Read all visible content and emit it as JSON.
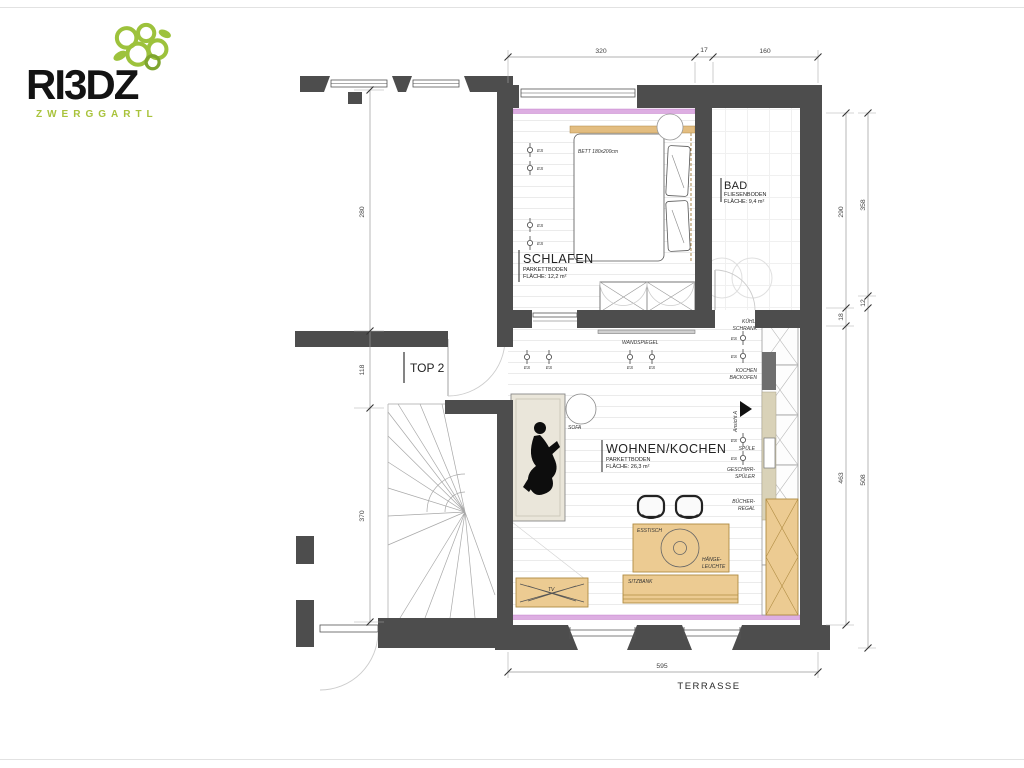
{
  "logo": {
    "brand": "RI3DZ",
    "subtitle": "ZWERGGARTL"
  },
  "plan": {
    "unit_label": "TOP 2",
    "rooms": {
      "schlafen": {
        "name": "SCHLAFEN",
        "floor": "PARKETTBODEN",
        "area": "FLÄCHE: 12,2 m²"
      },
      "bad": {
        "name": "BAD",
        "floor": "FLIESENBODEN",
        "area": "FLÄCHE: 9,4 m²"
      },
      "wohnen": {
        "name": "WOHNEN/KOCHEN",
        "floor": "PARKETTBODEN",
        "area": "FLÄCHE: 26,3 m²"
      }
    },
    "furniture": {
      "bett": "BETT 180x200cm",
      "sofa": "SOFA",
      "esstisch": "ESSTISCH",
      "haengeleuchte1": "HÄNGE-",
      "haengeleuchte2": "LEUCHTE",
      "sitzbank": "SITZBANK",
      "tv": "TV",
      "wandspiegel": "WANDSPIEGEL"
    },
    "kitchen": {
      "kuehl1": "KÜHL-",
      "kuehl2": "SCHRANK",
      "kochen1": "KOCHEN",
      "kochen2": "BACKOFEN",
      "spuele": "SPÜLE",
      "geschirr1": "GESCHIRR-",
      "geschirr2": "SPÜLER",
      "buecher1": "BÜCHER-",
      "buecher2": "REGAL",
      "ansicht": "Ansicht A"
    },
    "symbols": {
      "es": "ES"
    },
    "dims": {
      "top": [
        "320",
        "17",
        "160"
      ],
      "left": [
        "280",
        "118",
        "370"
      ],
      "right_inner": [
        "290",
        "18",
        "463"
      ],
      "right_outer": [
        "358",
        "12",
        "508"
      ],
      "bottom": [
        "595"
      ]
    },
    "terrasse": "TERRASSE",
    "colors": {
      "wall": "#4d4d4d",
      "accent_tan": "#eccb92",
      "accent_magenta": "#ddaee2",
      "logo_green": "#a9c33c"
    }
  }
}
